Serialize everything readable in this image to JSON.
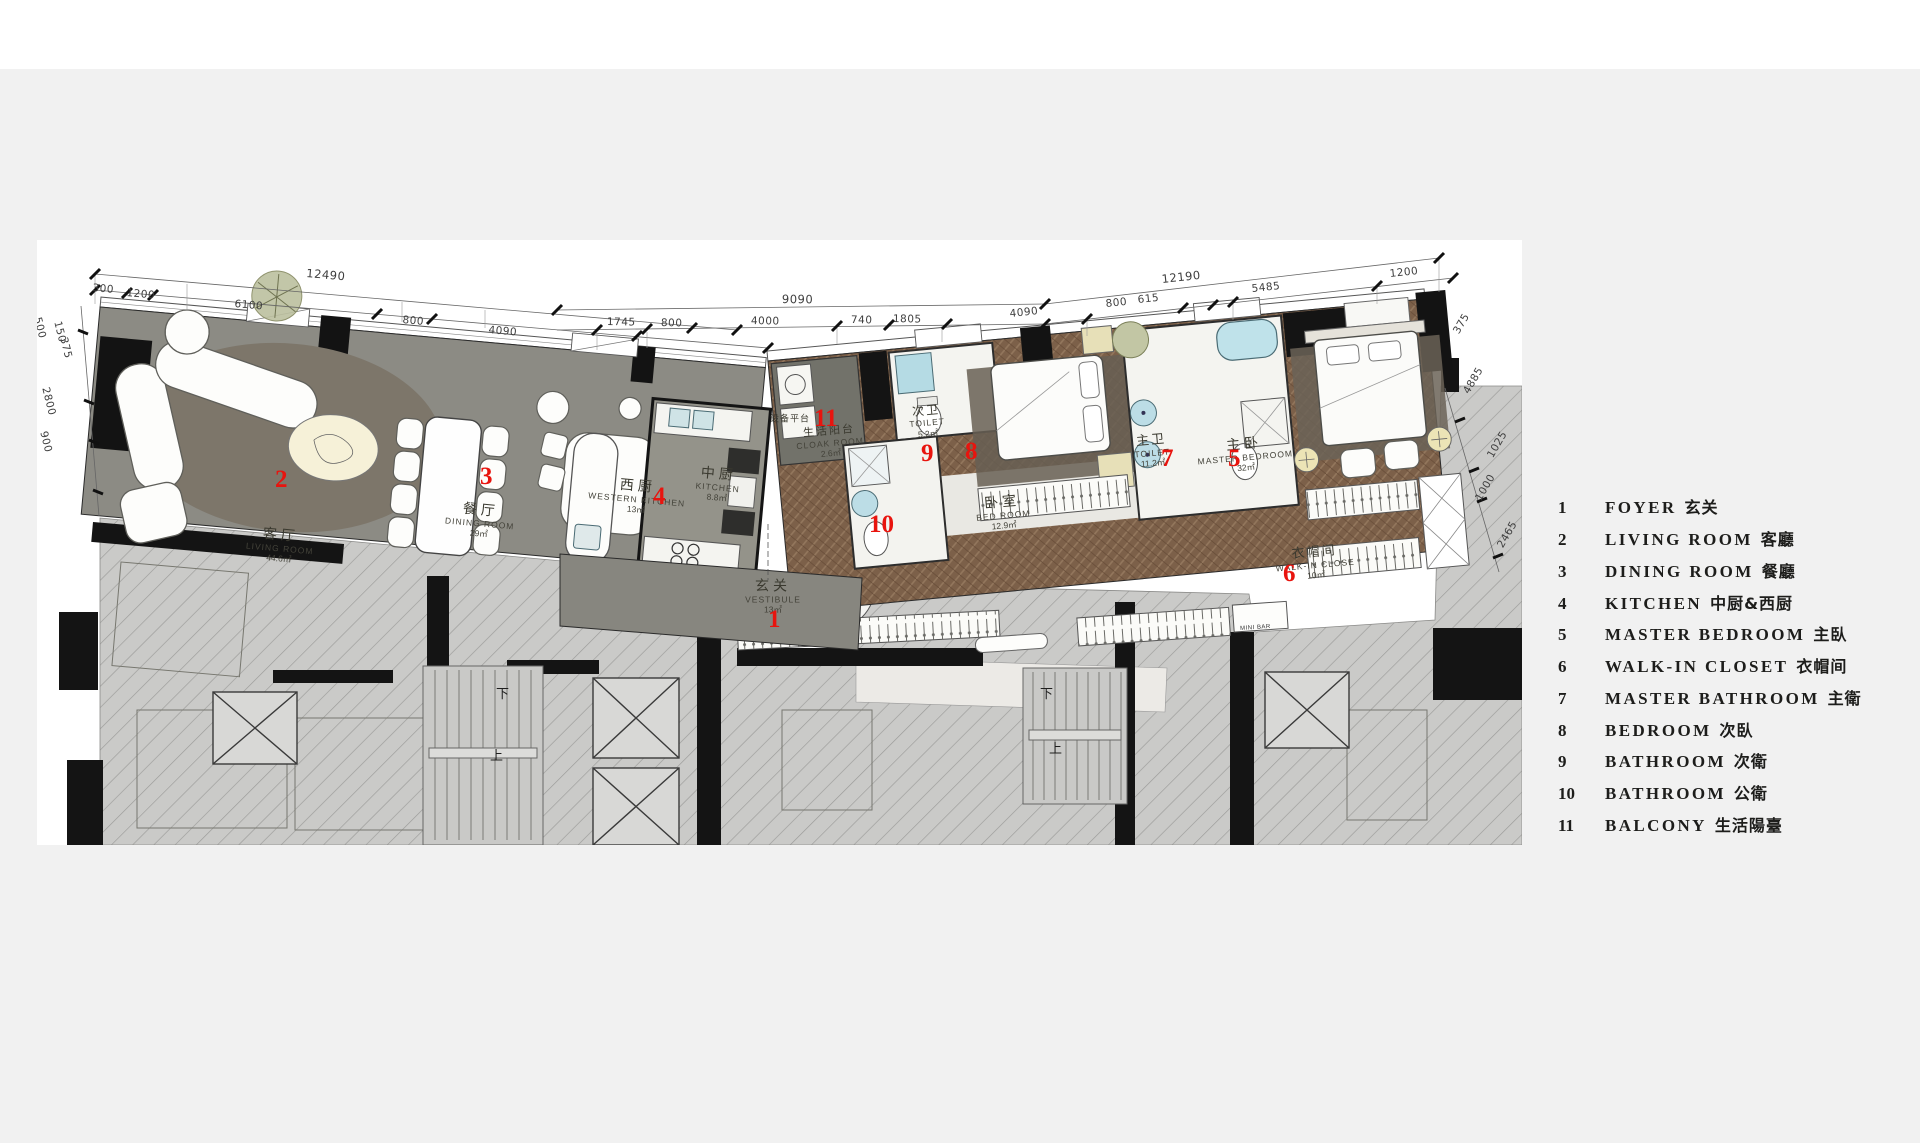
{
  "page": {
    "background": "#f1f1f1",
    "top_strip": "#ffffff",
    "sheet_background": "#ffffff"
  },
  "colors": {
    "marker_red": "#e8140e",
    "floor_gray": "#8c8b84",
    "wood_brown": "#7c6049",
    "hatch_gray": "#cacac8",
    "wall_black": "#141414",
    "water_blue": "#b5dbe4",
    "legend_text": "#1d1d1b"
  },
  "legend": {
    "items": [
      {
        "num": "1",
        "en": "FOYER",
        "zh": "玄关"
      },
      {
        "num": "2",
        "en": "LIVING ROOM",
        "zh": "客廳"
      },
      {
        "num": "3",
        "en": "DINING ROOM",
        "zh": "餐廳"
      },
      {
        "num": "4",
        "en": "KITCHEN",
        "zh": "中厨&西厨"
      },
      {
        "num": "5",
        "en": "MASTER BEDROOM",
        "zh": "主臥"
      },
      {
        "num": "6",
        "en": "WALK-IN CLOSET",
        "zh": "衣帽间"
      },
      {
        "num": "7",
        "en": "MASTER BATHROOM",
        "zh": "主衛"
      },
      {
        "num": "8",
        "en": "BEDROOM",
        "zh": "次臥"
      },
      {
        "num": "9",
        "en": "BATHROOM",
        "zh": "次衛"
      },
      {
        "num": "10",
        "en": "BATHROOM",
        "zh": "公衛"
      },
      {
        "num": "11",
        "en": "BALCONY",
        "zh": "生活陽臺"
      }
    ]
  },
  "plan": {
    "markers": [
      "1",
      "2",
      "3",
      "4",
      "5",
      "6",
      "7",
      "8",
      "9",
      "10",
      "11"
    ],
    "rooms": {
      "living": {
        "zh": "客厅",
        "en": "LIVING ROOM",
        "area": "44.6㎡"
      },
      "dining": {
        "zh": "餐厅",
        "en": "DINING ROOM",
        "area": "29㎡"
      },
      "western_kitchen": {
        "zh": "西厨",
        "en": "WESTERN KITCHEN",
        "area": "13㎡"
      },
      "kitchen": {
        "zh": "中厨",
        "en": "KITCHEN",
        "area": "8.8㎡"
      },
      "balcony": {
        "zh": "生活阳台",
        "en": "CLOAK ROOM",
        "area": "2.6㎡"
      },
      "bathroom2": {
        "zh": "次卫",
        "en": "TOILET",
        "area": "5.2㎡"
      },
      "bedroom": {
        "zh": "卧室",
        "en": "BED ROOM",
        "area": "12.9㎡"
      },
      "master_bathroom": {
        "zh": "主卫",
        "en": "TOILET",
        "area": "11.2㎡"
      },
      "master_bedroom": {
        "zh": "主卧",
        "en": "MASTER BEDROOM",
        "area": "32㎡"
      },
      "walk_in_closet": {
        "zh": "衣帽间",
        "en": "WALK-IN CLOSE",
        "area": "10㎡"
      },
      "foyer": {
        "zh": "玄关",
        "en": "VESTIBULE",
        "area": "13㎡"
      },
      "equipment": {
        "zh": "设备平台"
      }
    },
    "labels": {
      "mini_bar": "MINI BAR"
    },
    "stairs": {
      "up": "上",
      "down": "下"
    },
    "dims": {
      "top": [
        "12490",
        "300",
        "1200",
        "6100",
        "800",
        "4090",
        "9090",
        "1745",
        "800",
        "4000",
        "740",
        "1805",
        "12190",
        "4090",
        "800",
        "615",
        "5485",
        "1200"
      ],
      "left": [
        "500",
        "150",
        "375",
        "2800",
        "900"
      ],
      "right": [
        "375",
        "4885",
        "1025",
        "1000",
        "2465"
      ]
    }
  }
}
